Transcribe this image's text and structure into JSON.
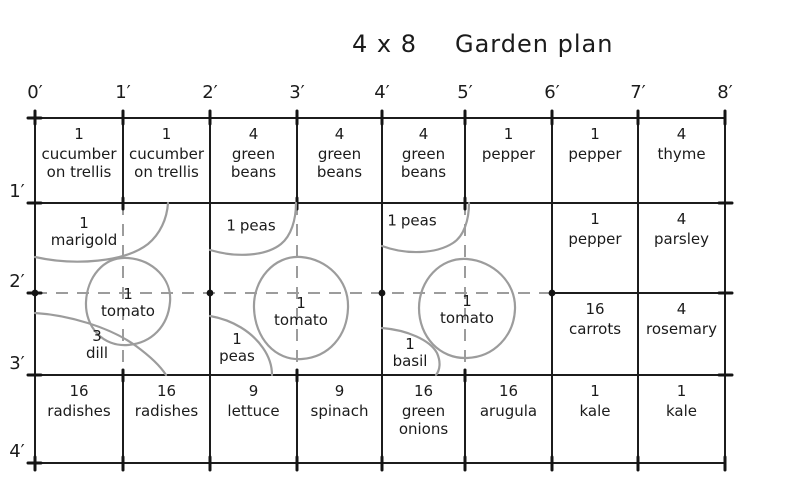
{
  "title": {
    "dimensions": "4 x 8",
    "name": "Garden plan"
  },
  "axis_top": [
    "0′",
    "1′",
    "2′",
    "3′",
    "4′",
    "5′",
    "6′",
    "7′",
    "8′"
  ],
  "axis_left": [
    "1′",
    "2′",
    "3′",
    "4′"
  ],
  "colors": {
    "ink": "#1c1c1c",
    "pencil_gray": "#9c9c9c"
  },
  "cells": [
    {
      "count": "1",
      "name": "cucumber on trellis",
      "col": 0,
      "row": 0
    },
    {
      "count": "1",
      "name": "cucumber on trellis",
      "col": 1,
      "row": 0
    },
    {
      "count": "4",
      "name": "green beans",
      "col": 2,
      "row": 0
    },
    {
      "count": "4",
      "name": "green beans",
      "col": 3,
      "row": 0
    },
    {
      "count": "4",
      "name": "green beans",
      "col": 4,
      "row": 0
    },
    {
      "count": "1",
      "name": "pepper",
      "col": 5,
      "row": 0
    },
    {
      "count": "1",
      "name": "pepper",
      "col": 6,
      "row": 0
    },
    {
      "count": "4",
      "name": "thyme",
      "col": 7,
      "row": 0
    },
    {
      "count": "1",
      "name": "pepper",
      "col": 6,
      "row": 1
    },
    {
      "count": "4",
      "name": "parsley",
      "col": 7,
      "row": 1
    },
    {
      "count": "16",
      "name": "carrots",
      "col": 6,
      "row": 2
    },
    {
      "count": "4",
      "name": "rosemary",
      "col": 7,
      "row": 2
    },
    {
      "count": "16",
      "name": "radishes",
      "col": 0,
      "row": 3
    },
    {
      "count": "16",
      "name": "radishes",
      "col": 1,
      "row": 3
    },
    {
      "count": "9",
      "name": "lettuce",
      "col": 2,
      "row": 3
    },
    {
      "count": "9",
      "name": "spinach",
      "col": 3,
      "row": 3
    },
    {
      "count": "16",
      "name": "green onions",
      "col": 4,
      "row": 3
    },
    {
      "count": "16",
      "name": "arugula",
      "col": 5,
      "row": 3
    },
    {
      "count": "1",
      "name": "kale",
      "col": 6,
      "row": 3
    },
    {
      "count": "1",
      "name": "kale",
      "col": 7,
      "row": 3
    }
  ],
  "features": [
    {
      "count": "1",
      "name": "marigold",
      "x": 84,
      "y": 232,
      "inline": false
    },
    {
      "count": "1",
      "name": "tomato",
      "x": 128,
      "y": 303,
      "inline": false
    },
    {
      "count": "3",
      "name": "dill",
      "x": 97,
      "y": 345,
      "inline": false
    },
    {
      "count": "1",
      "name": "peas",
      "x": 251,
      "y": 226,
      "inline": true
    },
    {
      "count": "1",
      "name": "tomato",
      "x": 301,
      "y": 312,
      "inline": false
    },
    {
      "count": "1",
      "name": "peas",
      "x": 237,
      "y": 348,
      "inline": false
    },
    {
      "count": "1",
      "name": "peas",
      "x": 412,
      "y": 221,
      "inline": true
    },
    {
      "count": "1",
      "name": "tomato",
      "x": 467,
      "y": 310,
      "inline": false
    },
    {
      "count": "1",
      "name": "basil",
      "x": 410,
      "y": 353,
      "inline": false
    }
  ]
}
